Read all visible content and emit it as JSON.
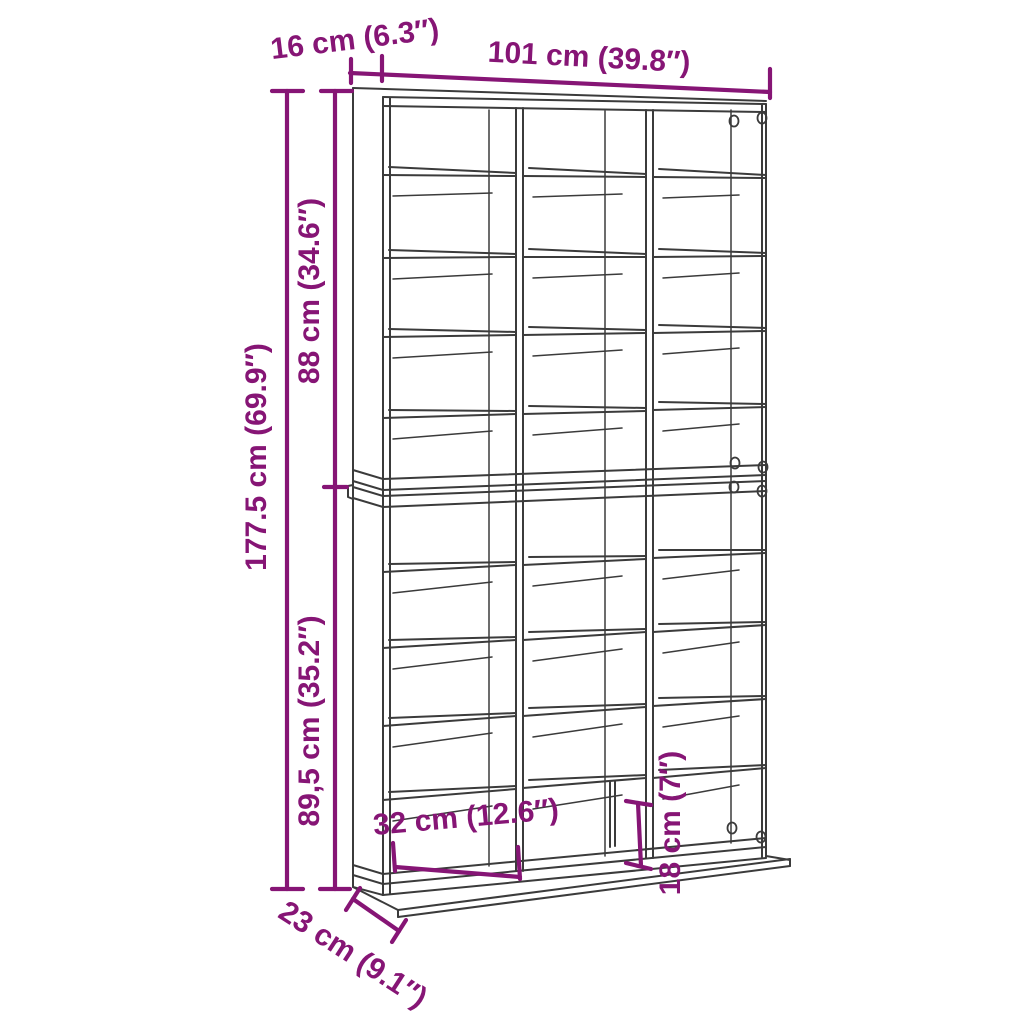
{
  "diagram": {
    "title": "Shelving unit dimension diagram",
    "colors": {
      "background": "#ffffff",
      "wireframe": "#3b3b3b",
      "dimension": "#861575"
    },
    "dims": {
      "top_depth": {
        "label": "16 cm (6.3″)",
        "cm": "16",
        "inch": "6.3″"
      },
      "width": {
        "label": "101 cm (39.8″)",
        "cm": "101",
        "inch": "39.8″"
      },
      "upper_height": {
        "label": "88 cm (34.6″)",
        "cm": "88",
        "inch": "34.6″"
      },
      "total_height": {
        "label": "177.5 cm (69.9″)",
        "cm": "177.5",
        "inch": "69.9″"
      },
      "lower_height": {
        "label": "89,5 cm (35.2″)",
        "cm": "89,5",
        "inch": "35.2″"
      },
      "inner_width": {
        "label": "32 cm (12.6″)",
        "cm": "32",
        "inch": "12.6″"
      },
      "inner_height": {
        "label": "18 cm (7″)",
        "cm": "18",
        "inch": "7″"
      },
      "base_depth": {
        "label": "23 cm (9.1″)",
        "cm": "23",
        "inch": "9.1″"
      }
    }
  }
}
